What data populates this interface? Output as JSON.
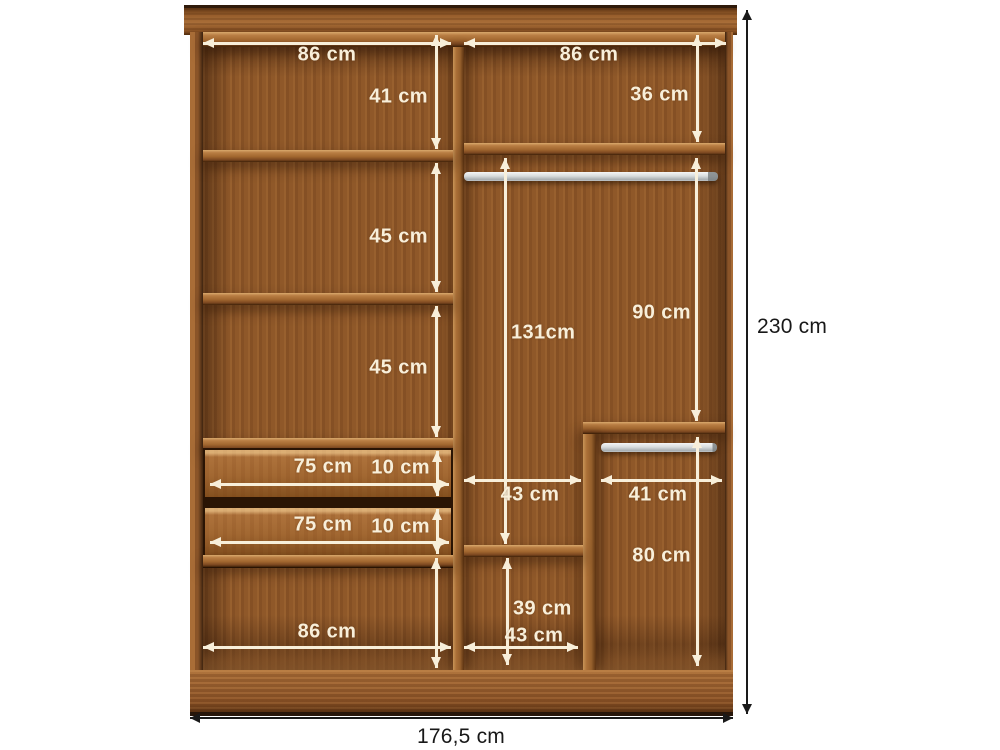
{
  "diagram_type": "wardrobe-interior-dimensions",
  "unit": "cm",
  "dims": {
    "left_top_width": "86 cm",
    "right_top_width": "86 cm",
    "left_gap_1": "41 cm",
    "left_gap_2": "45 cm",
    "left_gap_3": "45 cm",
    "right_top_gap": "36 cm",
    "hang_section_height": "90 cm",
    "center_section_height": "131cm",
    "drawer_1_width": "75 cm",
    "drawer_1_height": "10 cm",
    "drawer_2_width": "75 cm",
    "drawer_2_height": "10 cm",
    "center_width": "43 cm",
    "right_width": "41 cm",
    "right_lower_height": "80 cm",
    "center_lower_height": "39 cm",
    "center_bottom_width": "43 cm",
    "left_bottom_width": "86 cm",
    "overall_height": "230 cm",
    "overall_width": "176,5 cm"
  },
  "colors": {
    "background": "#ffffff",
    "wood_base": "#935c2c",
    "wood_light": "#ab713a",
    "wood_dark": "#5c3312",
    "annotation_light": "#f8efda",
    "annotation_dark": "#1a1a1a",
    "rod_metal": "#d8dcdd"
  }
}
